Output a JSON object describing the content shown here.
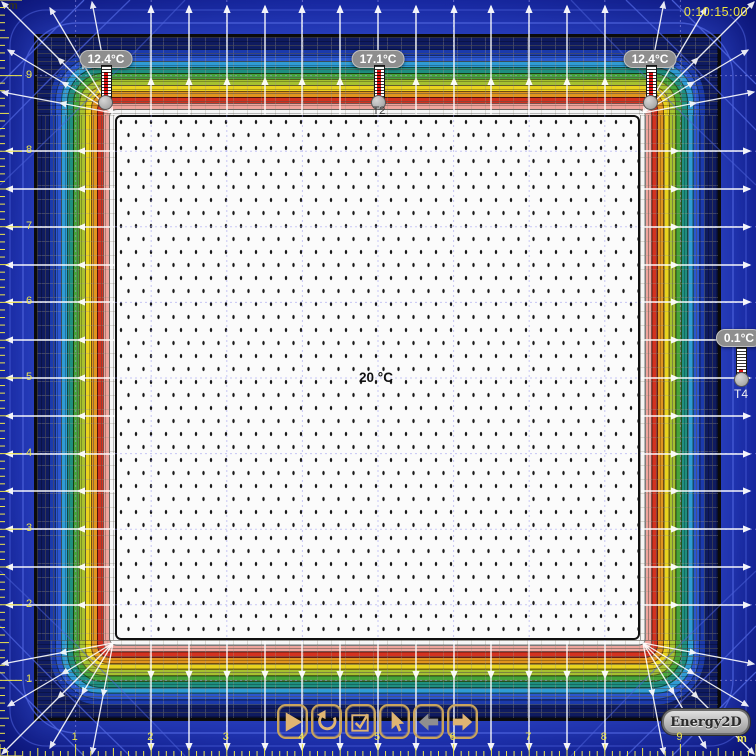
{
  "app": {
    "logo_label": "Energy2D",
    "time_display": "0:10:15:00"
  },
  "canvas": {
    "interior_temp_label": "20 °C"
  },
  "thermometers": [
    {
      "id": "T1",
      "reading": "12.4°C",
      "tag": ""
    },
    {
      "id": "T2",
      "reading": "17.1°C",
      "tag": "T2"
    },
    {
      "id": "T3",
      "reading": "12.4°C",
      "tag": ""
    },
    {
      "id": "T4",
      "reading": "0.1°C",
      "tag": "T4"
    }
  ],
  "rulers": {
    "unit": "m",
    "left": [
      "9",
      "8",
      "7",
      "6",
      "5",
      "4",
      "3",
      "2",
      "1"
    ],
    "bottom": [
      "1",
      "2",
      "3",
      "4",
      "5",
      "6",
      "7",
      "8",
      "9"
    ]
  },
  "toolbar": {
    "buttons": [
      {
        "name": "play"
      },
      {
        "name": "reset"
      },
      {
        "name": "graph"
      },
      {
        "name": "select"
      },
      {
        "name": "previous"
      },
      {
        "name": "next"
      }
    ]
  },
  "colors": {
    "vars": {
      "bg-deep": "#0A1272",
      "bg-mid": "#1F36AC",
      "ruler-yellow": "#EFE64A",
      "time-yellow": "#F2E53C",
      "grid-lavender": "#9B9BEF",
      "flux-white": "#FFFFFF",
      "contour-blue": "#4E63DC",
      "gold": "#C9A45C",
      "icon-tan": "#DFB572",
      "icon-gray": "#8F8F8F",
      "pill-gray": "#8E8E8E",
      "interior-white": "#FBFBFB",
      "frame-black": "#0B0B0B",
      "mercury-red": "#E01212"
    },
    "bands": [
      "#0F1B60",
      "#1B3AAC",
      "#2B56CE",
      "#2F9BD4",
      "#1F8F80",
      "#46A339",
      "#A6C130",
      "#E9D21E",
      "#E0941E",
      "#D33220",
      "#EFA49C",
      "#F6F6F6"
    ]
  }
}
